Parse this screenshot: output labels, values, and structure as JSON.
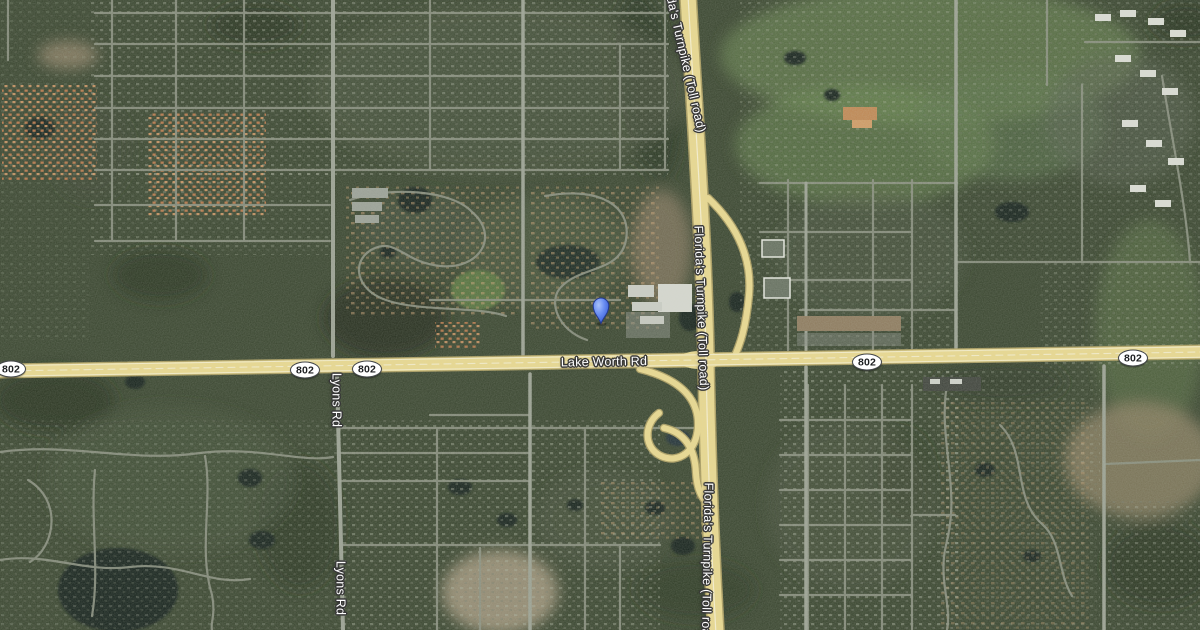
{
  "map": {
    "view": "satellite",
    "roads": {
      "lake_worth_rd": {
        "label": "Lake Worth Rd",
        "route": "802"
      },
      "turnpike": {
        "label": "Florida's Turnpike (Toll road)"
      },
      "lyons_rd": {
        "label": "Lyons Rd"
      }
    },
    "shields": [
      {
        "label": "802",
        "x": 11,
        "y": 369
      },
      {
        "label": "802",
        "x": 305,
        "y": 370
      },
      {
        "label": "802",
        "x": 367,
        "y": 369
      },
      {
        "label": "802",
        "x": 867,
        "y": 362
      },
      {
        "label": "802",
        "x": 1133,
        "y": 358
      }
    ],
    "marker": {
      "name": "location-pin",
      "fill": "#6a8ef2",
      "highlight": "#a9c2fa",
      "outline": "#22388f"
    }
  },
  "palette": {
    "terrain_base": "#39452f",
    "highway_fill": "#e9d88e",
    "highway_casing": "#a89a5e",
    "street": "#8a9080",
    "water": "#17231c",
    "label_text": "#ffffff",
    "label_outline": "#383838",
    "shield_bg": "#ffffff",
    "shield_text": "#1d1f21"
  }
}
